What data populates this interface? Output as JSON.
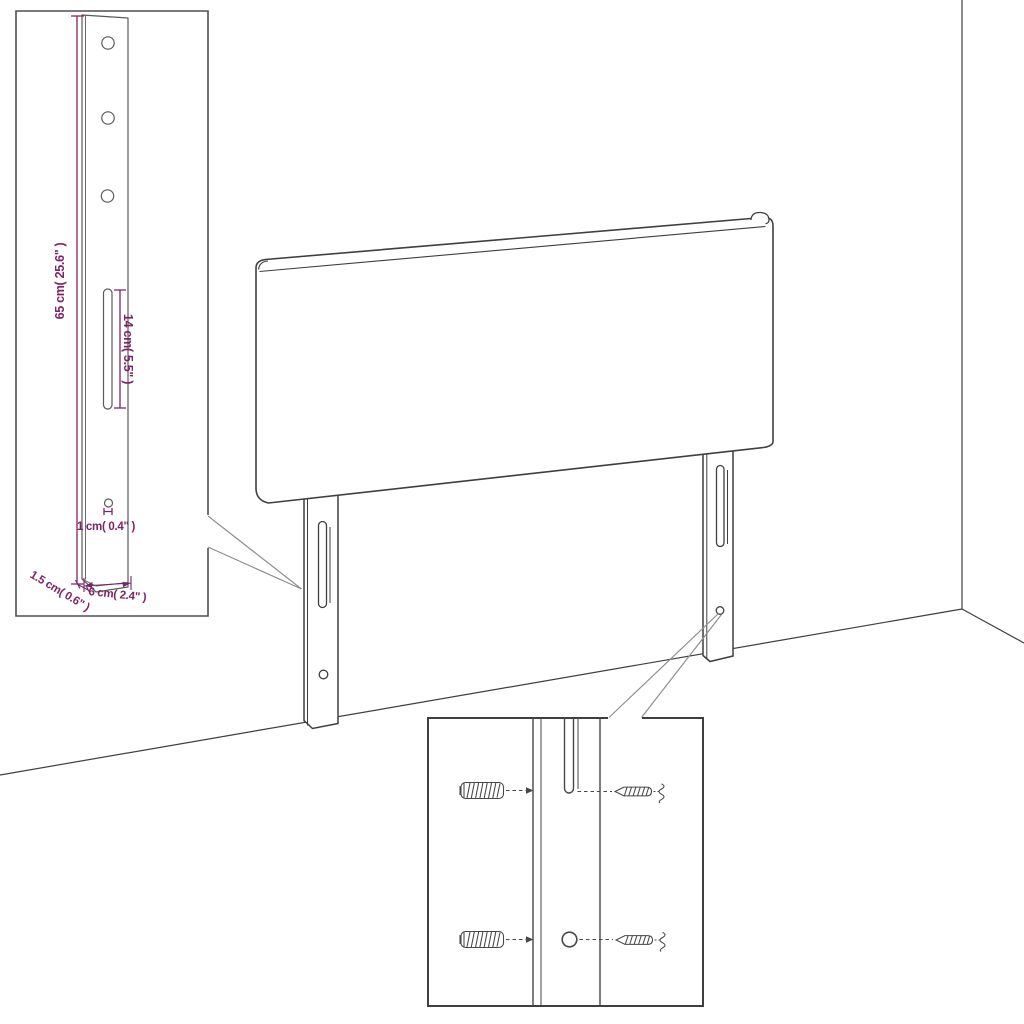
{
  "diagram": {
    "description": "headboard assembly diagram with bracket detail callout and wall mounting hardware callout",
    "labels": {
      "bracket_height": "65 cm( 25.6\" )",
      "bracket_slot": "14 cm( 5.5\" )",
      "bracket_hole": "1 cm( 0.4\" )",
      "bracket_thickness": "1.5 cm( 0.6\" )",
      "bracket_width": "6 cm( 2.4\" )"
    },
    "colors": {
      "dimension_text": "#7e2368",
      "line_art": "#3f3f3f",
      "inset_line": "#4f4f4f",
      "leader_line": "#8f8f8f",
      "background": "#ffffff"
    }
  }
}
